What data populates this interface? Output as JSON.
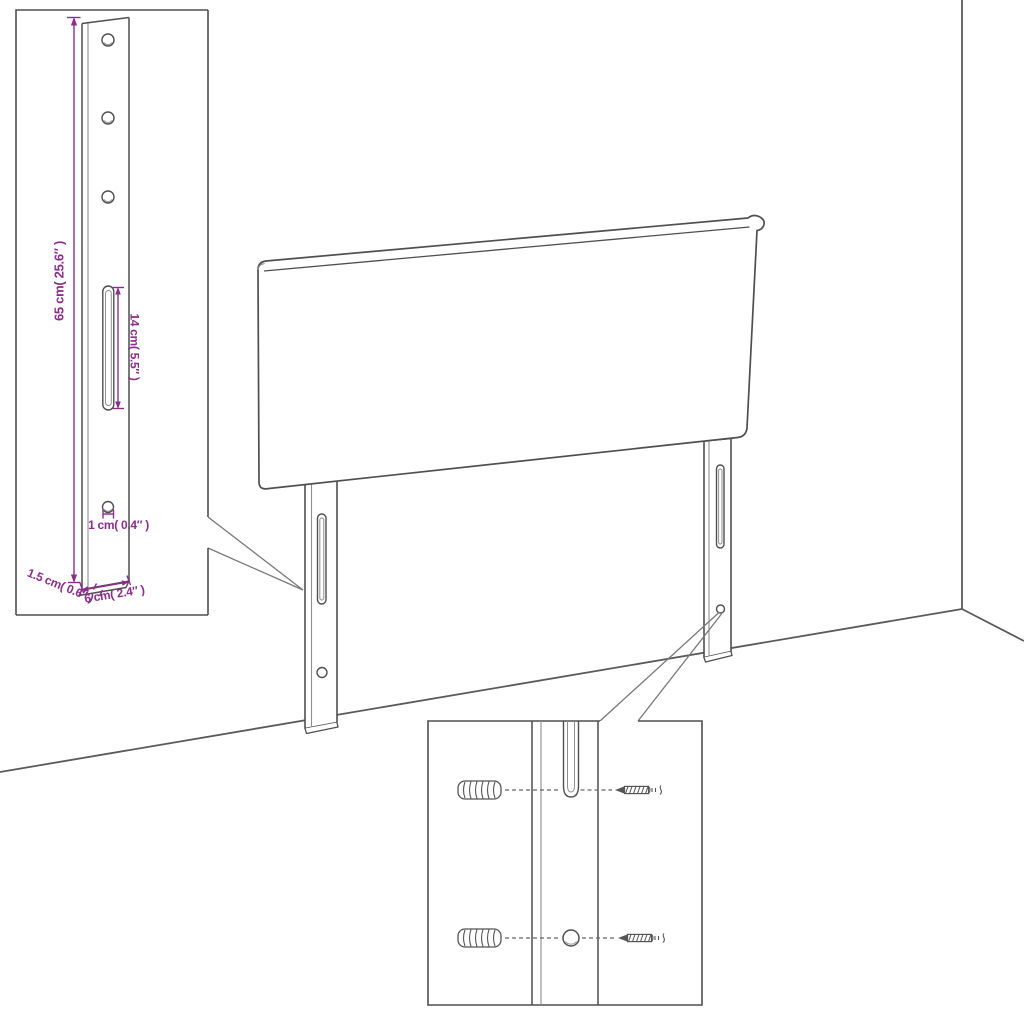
{
  "diagram": {
    "subject": "headboard-assembly-dimension-diagram",
    "colors": {
      "outline": "#4f4f4f",
      "secondary_line": "#8f8f8f",
      "callout_line": "#787878",
      "dimension": "#8b2e8b",
      "background": "#ffffff"
    },
    "dimension_labels": {
      "leg_height": "65 cm( 25.6″ )",
      "slot_length": "14 cm( 5.5″ )",
      "hole_width": "1 cm( 0.4″ )",
      "board_thickness": "1.5 cm( 0.6″ )",
      "leg_width": "6 cm( 2.4″ )"
    }
  }
}
